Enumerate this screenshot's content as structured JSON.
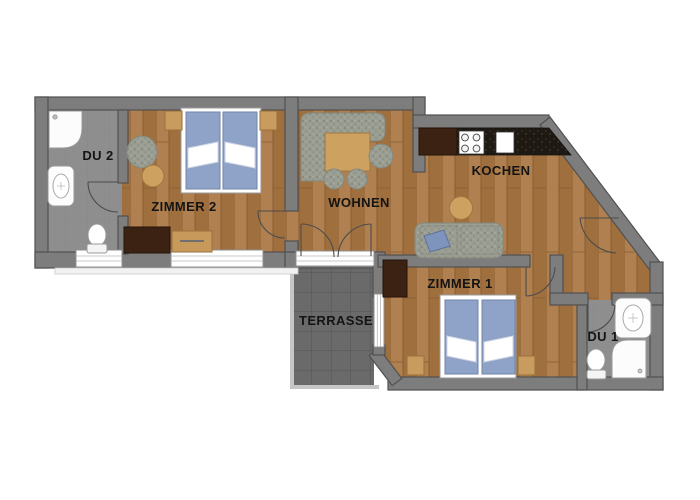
{
  "floorplan": {
    "rooms": {
      "du2": {
        "label": "DU 2"
      },
      "zimmer2": {
        "label": "ZIMMER 2"
      },
      "wohnen": {
        "label": "WOHNEN"
      },
      "kochen": {
        "label": "KOCHEN"
      },
      "zimmer1": {
        "label": "ZIMMER 1"
      },
      "du1": {
        "label": "DU 1"
      },
      "terrasse": {
        "label": "TERRASSE"
      }
    },
    "colors": {
      "wall": "#7d7d7d",
      "wall_outline": "#515151",
      "wood_floor": "#a87845",
      "bath_tile": "#8e8e8e",
      "terrace_tile": "#6a6a6a",
      "mattress_blue": "#8fa2c7",
      "kitchen_counter": "#1f1913",
      "furniture_wood": "#cda261",
      "dark_cabinet": "#3b2213",
      "upholstery": "#999d92"
    }
  }
}
